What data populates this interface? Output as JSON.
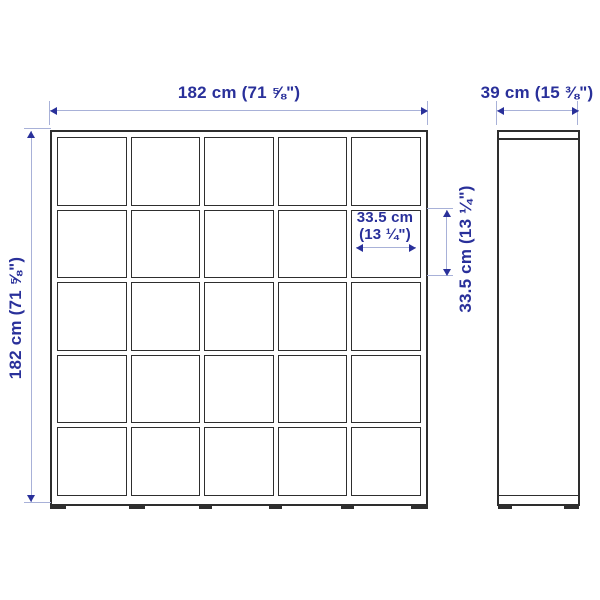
{
  "labels": {
    "total_width": "182 cm (71 ⅝\")",
    "total_height": "182 cm (71 ⅝\")",
    "depth": "39 cm (15 ⅜\")",
    "cell_width_line1": "33.5 cm",
    "cell_width_line2": "(13 ¼\")",
    "cell_height": "33.5 cm (13 ¼\")"
  },
  "grid": {
    "rows": 5,
    "cols": 5
  },
  "colors": {
    "dimension_text": "#29309a",
    "dimension_line": "#a8b1d8",
    "drawing_line": "#2e2e2e",
    "background": "#ffffff"
  }
}
